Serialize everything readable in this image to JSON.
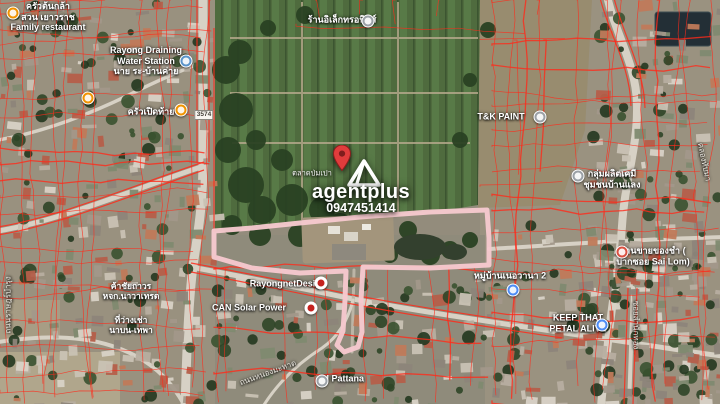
{
  "app": {
    "type": "satellite-map-screenshot"
  },
  "watermark": {
    "brand": "agentplus",
    "phone": "0947451414",
    "pin_icon": "red-location-pin",
    "logo_icon": "agentplus-triangle-logo"
  },
  "map": {
    "road_shield": "3574",
    "boundary_color": "#f6c9ce",
    "parcel_line_color": "#ff2a1a",
    "labels": [
      {
        "name": "label-family-restaurant",
        "lines": [
          "ครัวต้นกล้า",
          "สวน เยาวราช",
          "Family restaurant"
        ],
        "x": 48,
        "y": 17
      },
      {
        "name": "label-rayong-draining-station",
        "lines": [
          "Rayong Draining",
          "Water Station",
          "นาย ระ-บ้านค่าย"
        ],
        "x": 146,
        "y": 61
      },
      {
        "name": "label-electronics-shop",
        "lines": [
          "ร้านอิเล็กทรอนิกส์"
        ],
        "x": 342,
        "y": 20
      },
      {
        "name": "label-krua-perd-tai",
        "lines": [
          "ครัวเปิดท้าย"
        ],
        "x": 151,
        "y": 112
      },
      {
        "name": "label-tk-paint",
        "lines": [
          "T&K PAINT"
        ],
        "x": 501,
        "y": 117
      },
      {
        "name": "label-community-group",
        "lines": [
          "กลุ่มผลิตเคมี",
          "ชุมชนบ้านแลง"
        ],
        "x": 612,
        "y": 179
      },
      {
        "name": "label-sai-lom-shop",
        "lines": [
          "ร้านขายของชำ (",
          "ปากซอย Sai Lom)"
        ],
        "x": 653,
        "y": 256
      },
      {
        "name": "label-village-nervana",
        "lines": [
          "หมู่บ้านเนอวานา 2"
        ],
        "x": 510,
        "y": 276
      },
      {
        "name": "label-rayongnet-design",
        "lines": [
          "RayongnetDesign"
        ],
        "x": 288,
        "y": 284
      },
      {
        "name": "label-can-solar-power",
        "lines": [
          "CAN Solar Power"
        ],
        "x": 249,
        "y": 308
      },
      {
        "name": "label-keep-that-petal-alive",
        "lines": [
          "KEEP THAT",
          "PETAL ALIVE"
        ],
        "x": 578,
        "y": 323
      },
      {
        "name": "label-ai-pattana",
        "lines": [
          "AI Pattana"
        ],
        "x": 342,
        "y": 379
      },
      {
        "name": "label-talad-pom-pao",
        "lines": [
          "ตลาดป่มเปา"
        ],
        "x": 312,
        "y": 174,
        "fs": 7.5,
        "weight": 400
      },
      {
        "name": "label-kha-chai-thaworn",
        "lines": [
          "ค้าชัยถาวร",
          "หจก.นาวาเทรด"
        ],
        "x": 131,
        "y": 291,
        "fs": 8.5
      },
      {
        "name": "label-thi-wang-chao",
        "lines": [
          "ที่ว่างเช่า",
          "นาบน-เทพา"
        ],
        "x": 131,
        "y": 325,
        "fs": 8.5
      },
      {
        "name": "label-soi-samnak-thong",
        "lines": [
          "ซอยสำนักทอง"
        ],
        "x": 636,
        "y": 325,
        "rot": 90,
        "fs": 8,
        "weight": 400,
        "color": "#eae7df"
      },
      {
        "name": "label-thanon-rat-bamrung",
        "lines": [
          "ถนนราษฎร์บำรุง"
        ],
        "x": 8,
        "y": 305,
        "rot": -90,
        "fs": 8,
        "weight": 400,
        "color": "#eae7df"
      },
      {
        "name": "label-thanon-nong-mahat",
        "lines": [
          "ถนนหนองมะหาด"
        ],
        "x": 268,
        "y": 373,
        "rot": -20,
        "fs": 8,
        "weight": 400,
        "color": "#eae7df"
      },
      {
        "name": "label-khlong-thap-ma",
        "lines": [
          "คลองทับมา"
        ],
        "x": 704,
        "y": 162,
        "rot": 78,
        "fs": 8,
        "weight": 400,
        "color": "#eae7df"
      }
    ],
    "markers": [
      {
        "name": "restaurant-icon",
        "x": 13,
        "y": 13,
        "bg": "#F09300"
      },
      {
        "name": "water-station-icon",
        "x": 186,
        "y": 61,
        "bg": "#5A93C9"
      },
      {
        "name": "place-icon",
        "x": 368,
        "y": 21,
        "bg": "#9AA0A6"
      },
      {
        "name": "restaurant-icon",
        "x": 88,
        "y": 98,
        "bg": "#F09300"
      },
      {
        "name": "restaurant-icon",
        "x": 181,
        "y": 110,
        "bg": "#F09300"
      },
      {
        "name": "place-icon",
        "x": 540,
        "y": 117,
        "bg": "#9AA0A6"
      },
      {
        "name": "community-icon",
        "x": 578,
        "y": 176,
        "bg": "#9AA0A6"
      },
      {
        "name": "shop-icon",
        "x": 622,
        "y": 252,
        "bg": "#D95040"
      },
      {
        "name": "home-icon",
        "x": 513,
        "y": 290,
        "bg": "#4C8BF5"
      },
      {
        "name": "rayongnet-icon",
        "x": 321,
        "y": 283,
        "bg": "#ffffff",
        "inner": "#c5221f"
      },
      {
        "name": "solar-icon",
        "x": 311,
        "y": 308,
        "bg": "#ffffff",
        "inner": "#c5221f"
      },
      {
        "name": "flower-shop-icon",
        "x": 602,
        "y": 325,
        "bg": "#4C8BF5"
      },
      {
        "name": "place-icon",
        "x": 322,
        "y": 381,
        "bg": "#9AA0A6"
      }
    ]
  }
}
